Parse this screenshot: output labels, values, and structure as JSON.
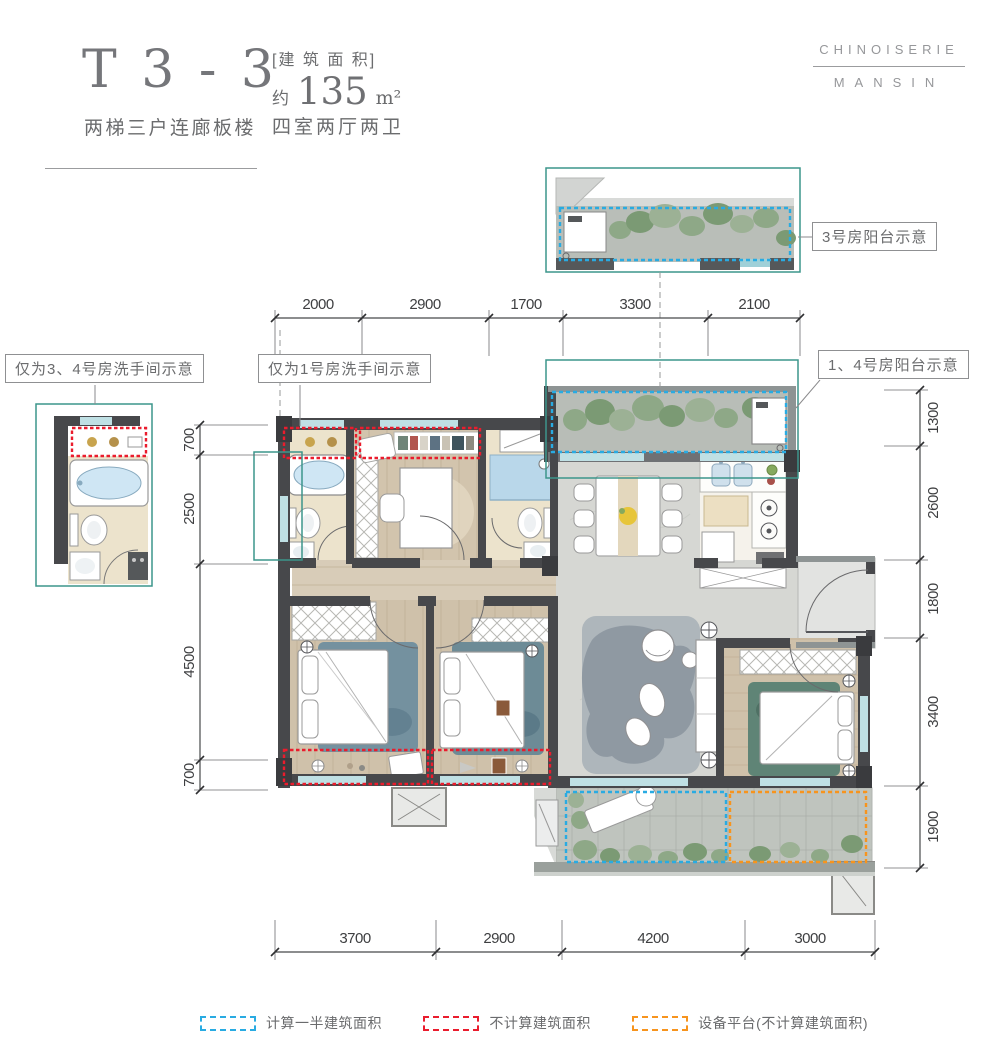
{
  "header": {
    "unit_code": "T 3 - 3",
    "unit_desc": "两梯三户连廊板楼",
    "area_label": "[建 筑 面 积]",
    "area_prefix": "约",
    "area_value": "135",
    "area_unit": "m²",
    "rooms_desc": "四室两厅两卫"
  },
  "brand": {
    "line1": "CHINOISERIE",
    "line2": "MANSIN"
  },
  "callouts": {
    "balcony_room3": "3号房阳台示意",
    "balcony_room14": "1、4号房阳台示意",
    "bath_room34": "仅为3、4号房洗手间示意",
    "bath_room1": "仅为1号房洗手间示意"
  },
  "dimensions": {
    "top": [
      "2000",
      "2900",
      "1700",
      "3300",
      "2100"
    ],
    "bottom": [
      "3700",
      "2900",
      "4200",
      "3000"
    ],
    "left": [
      "700",
      "2500",
      "4500",
      "700"
    ],
    "right": [
      "1300",
      "2600",
      "1800",
      "3400",
      "1900"
    ]
  },
  "legend": {
    "half_area": {
      "label": "计算一半建筑面积",
      "color": "#29abe2"
    },
    "excluded": {
      "label": "不计算建筑面积",
      "color": "#ea1c2d"
    },
    "equipment": {
      "label": "设备平台(不计算建筑面积)",
      "color": "#f7941d"
    }
  },
  "colors": {
    "wall": "#47484b",
    "wood_floor": "#d2c4ad",
    "bath_floor": "#ece3cc",
    "marble_floor": "#d6d7d3",
    "balcony_floor": "#b8bdb7",
    "detail_frame": "#3c958b",
    "dash_blue": "#29abe2",
    "dash_red": "#ea1c2d",
    "dash_orange": "#f7941d",
    "title_text": "#75767a"
  }
}
